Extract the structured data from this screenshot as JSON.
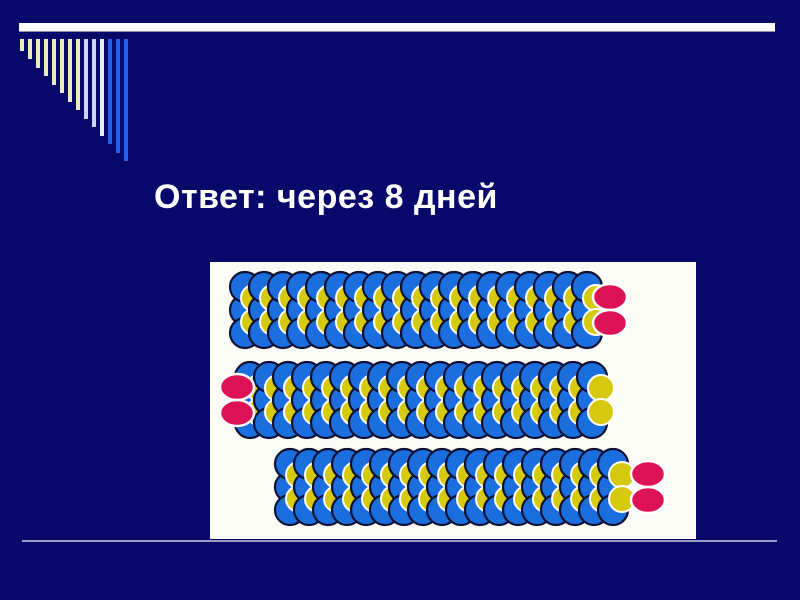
{
  "slide": {
    "background_color": "#08086b",
    "top_bar": {
      "color": "#ffffff"
    },
    "title": {
      "text": "Ответ: через 8 дней",
      "color": "#ffffff"
    },
    "decoration_bars": {
      "bars": [
        {
          "color": "#efe8c6",
          "height": 12
        },
        {
          "color": "#efe8c6",
          "height": 20
        },
        {
          "color": "#efe8c6",
          "height": 29
        },
        {
          "color": "#efe8c6",
          "height": 37
        },
        {
          "color": "#efe8c6",
          "height": 46
        },
        {
          "color": "#efe8c6",
          "height": 54
        },
        {
          "color": "#efe8c6",
          "height": 63
        },
        {
          "color": "#efe8c6",
          "height": 71
        },
        {
          "color": "#ccd6f2",
          "height": 80
        },
        {
          "color": "#ccd6f2",
          "height": 88
        },
        {
          "color": "#e9eefb",
          "height": 97
        },
        {
          "color": "#2263e8",
          "height": 105
        },
        {
          "color": "#2263e8",
          "height": 114
        },
        {
          "color": "#2263e8",
          "height": 122
        }
      ]
    },
    "illustration": {
      "background": "#fcfcf7",
      "bead_colors": {
        "blue": "#1a6ede",
        "blue_outline": "#0e1133",
        "yellow": "#d6ca10",
        "yellow_outline": "#ffffff",
        "oval": "#dd1155",
        "oval_outline": "#ffffff"
      },
      "geometry": {
        "pitch": 19,
        "blue_r": 15,
        "yellow_r": 13,
        "row_dy": 23,
        "yellow_dy": 12,
        "yellow_dx": 9,
        "oval_rx": 17,
        "oval_ry": 13,
        "oval_half_gap": 13
      },
      "chains": [
        {
          "name": "chain-1",
          "columns": 19,
          "start_x": 35,
          "center_y": 48,
          "ovals_end": "right",
          "oval_cx": 400
        },
        {
          "name": "chain-2",
          "columns": 19,
          "start_x": 40,
          "center_y": 138,
          "ovals_end": "left",
          "oval_cx": 27
        },
        {
          "name": "chain-3",
          "columns": 18,
          "start_x": 80,
          "center_y": 225,
          "ovals_end": "right",
          "oval_cx": 438
        }
      ]
    },
    "bottom_line": {
      "color": "#9d9dc2"
    }
  }
}
